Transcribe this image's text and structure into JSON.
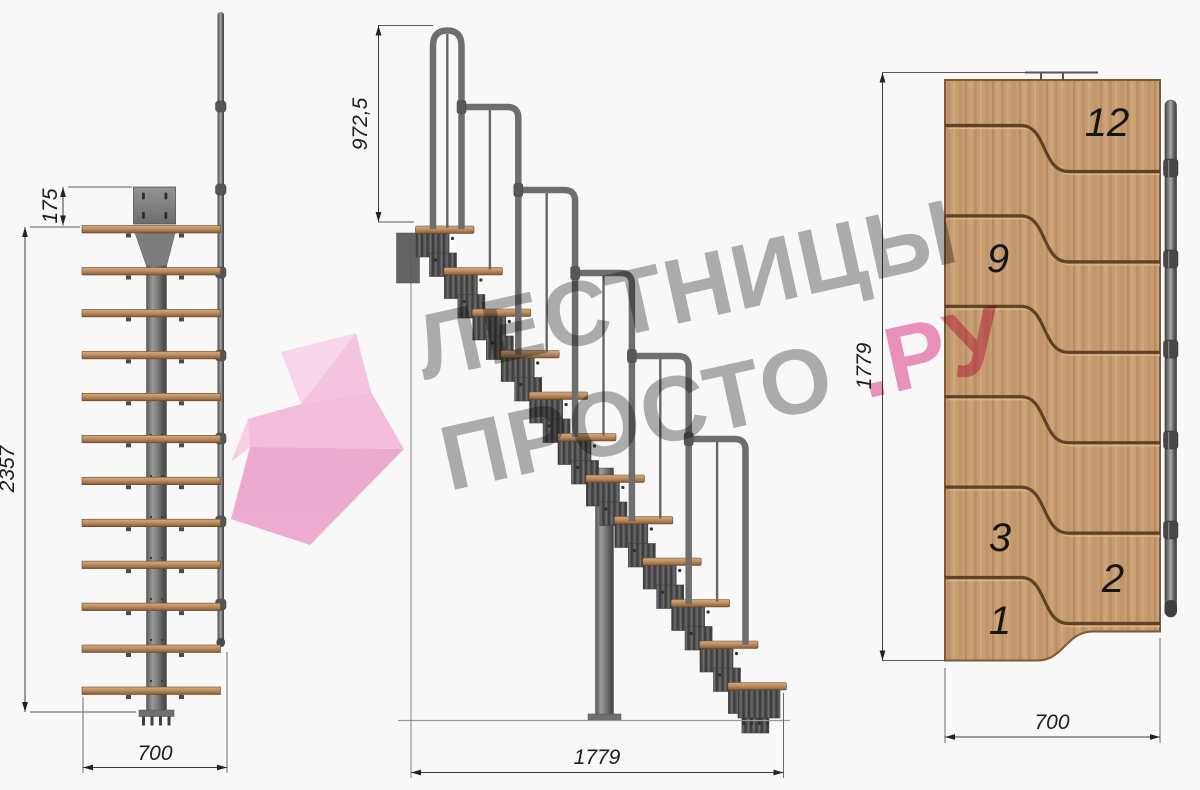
{
  "drawing": {
    "kind": "modular staircase technical drawing",
    "views": {
      "front_view": {
        "label": "front elevation",
        "dim_plate_offset": "175",
        "dim_height": "2357",
        "dim_width": "700"
      },
      "side_view": {
        "label": "side elevation",
        "dim_handrail_height": "972,5",
        "dim_length": "1779"
      },
      "plan_view": {
        "label": "top plan",
        "dim_length": "1779",
        "dim_width": "700",
        "steps": [
          {
            "label": "12"
          },
          {
            "label": "9"
          },
          {
            "label": "3"
          },
          {
            "label": "2"
          },
          {
            "label": "1"
          }
        ]
      }
    }
  },
  "watermark": {
    "line1": "ЛЕСТНИЦЫ",
    "line2_gray": "ПРОСТО",
    "line2_pink": ".РУ"
  },
  "colors": {
    "background": "#f8f8f9",
    "wood": "#c69c71",
    "wood_edge": "#6b4928",
    "metal": "#6e6e6e",
    "watermark_gray": "#6f6f6f",
    "watermark_pink": "#e23c86",
    "logo_pink_light": "#f9d4e8",
    "logo_pink_mid": "#f2bad9",
    "logo_pink_deep": "#eba4cb"
  }
}
